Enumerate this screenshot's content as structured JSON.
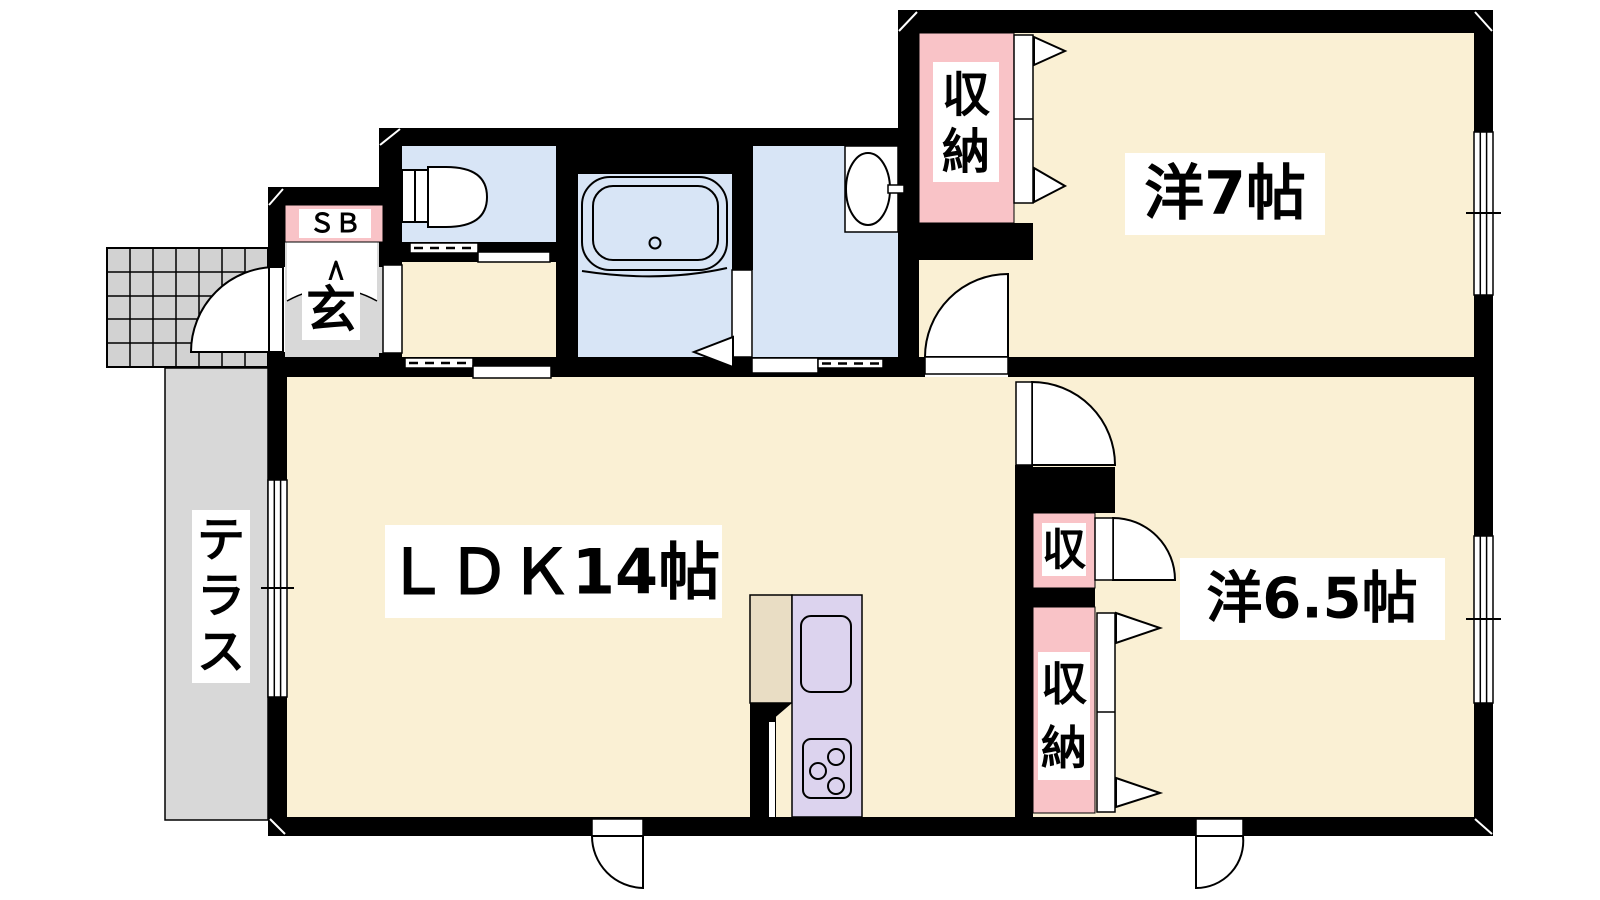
{
  "colors": {
    "wall": "#000000",
    "room": "#FAF0D4",
    "wet": "#D8E5F6",
    "pink": "#F9C3C7",
    "kitchen": "#DCD3EE",
    "fridge": "#E9DDC4",
    "terrace": "#D8D8D8",
    "tile": "#D2D2D2",
    "label_bg": "#FFFFFF",
    "text": "#000000"
  },
  "labels": {
    "ldk": "ＬＤＫ14帖",
    "bedroom7": "洋7帖",
    "bedroom65": "洋6.5帖",
    "terrace_chars": [
      "テ",
      "ラ",
      "ス"
    ],
    "entrance": "玄",
    "shoe_box": "ＳＢ",
    "closet_ne_chars": [
      "収",
      "納"
    ],
    "closet_se_chars": [
      "収",
      "納"
    ],
    "closet_small": "収"
  }
}
